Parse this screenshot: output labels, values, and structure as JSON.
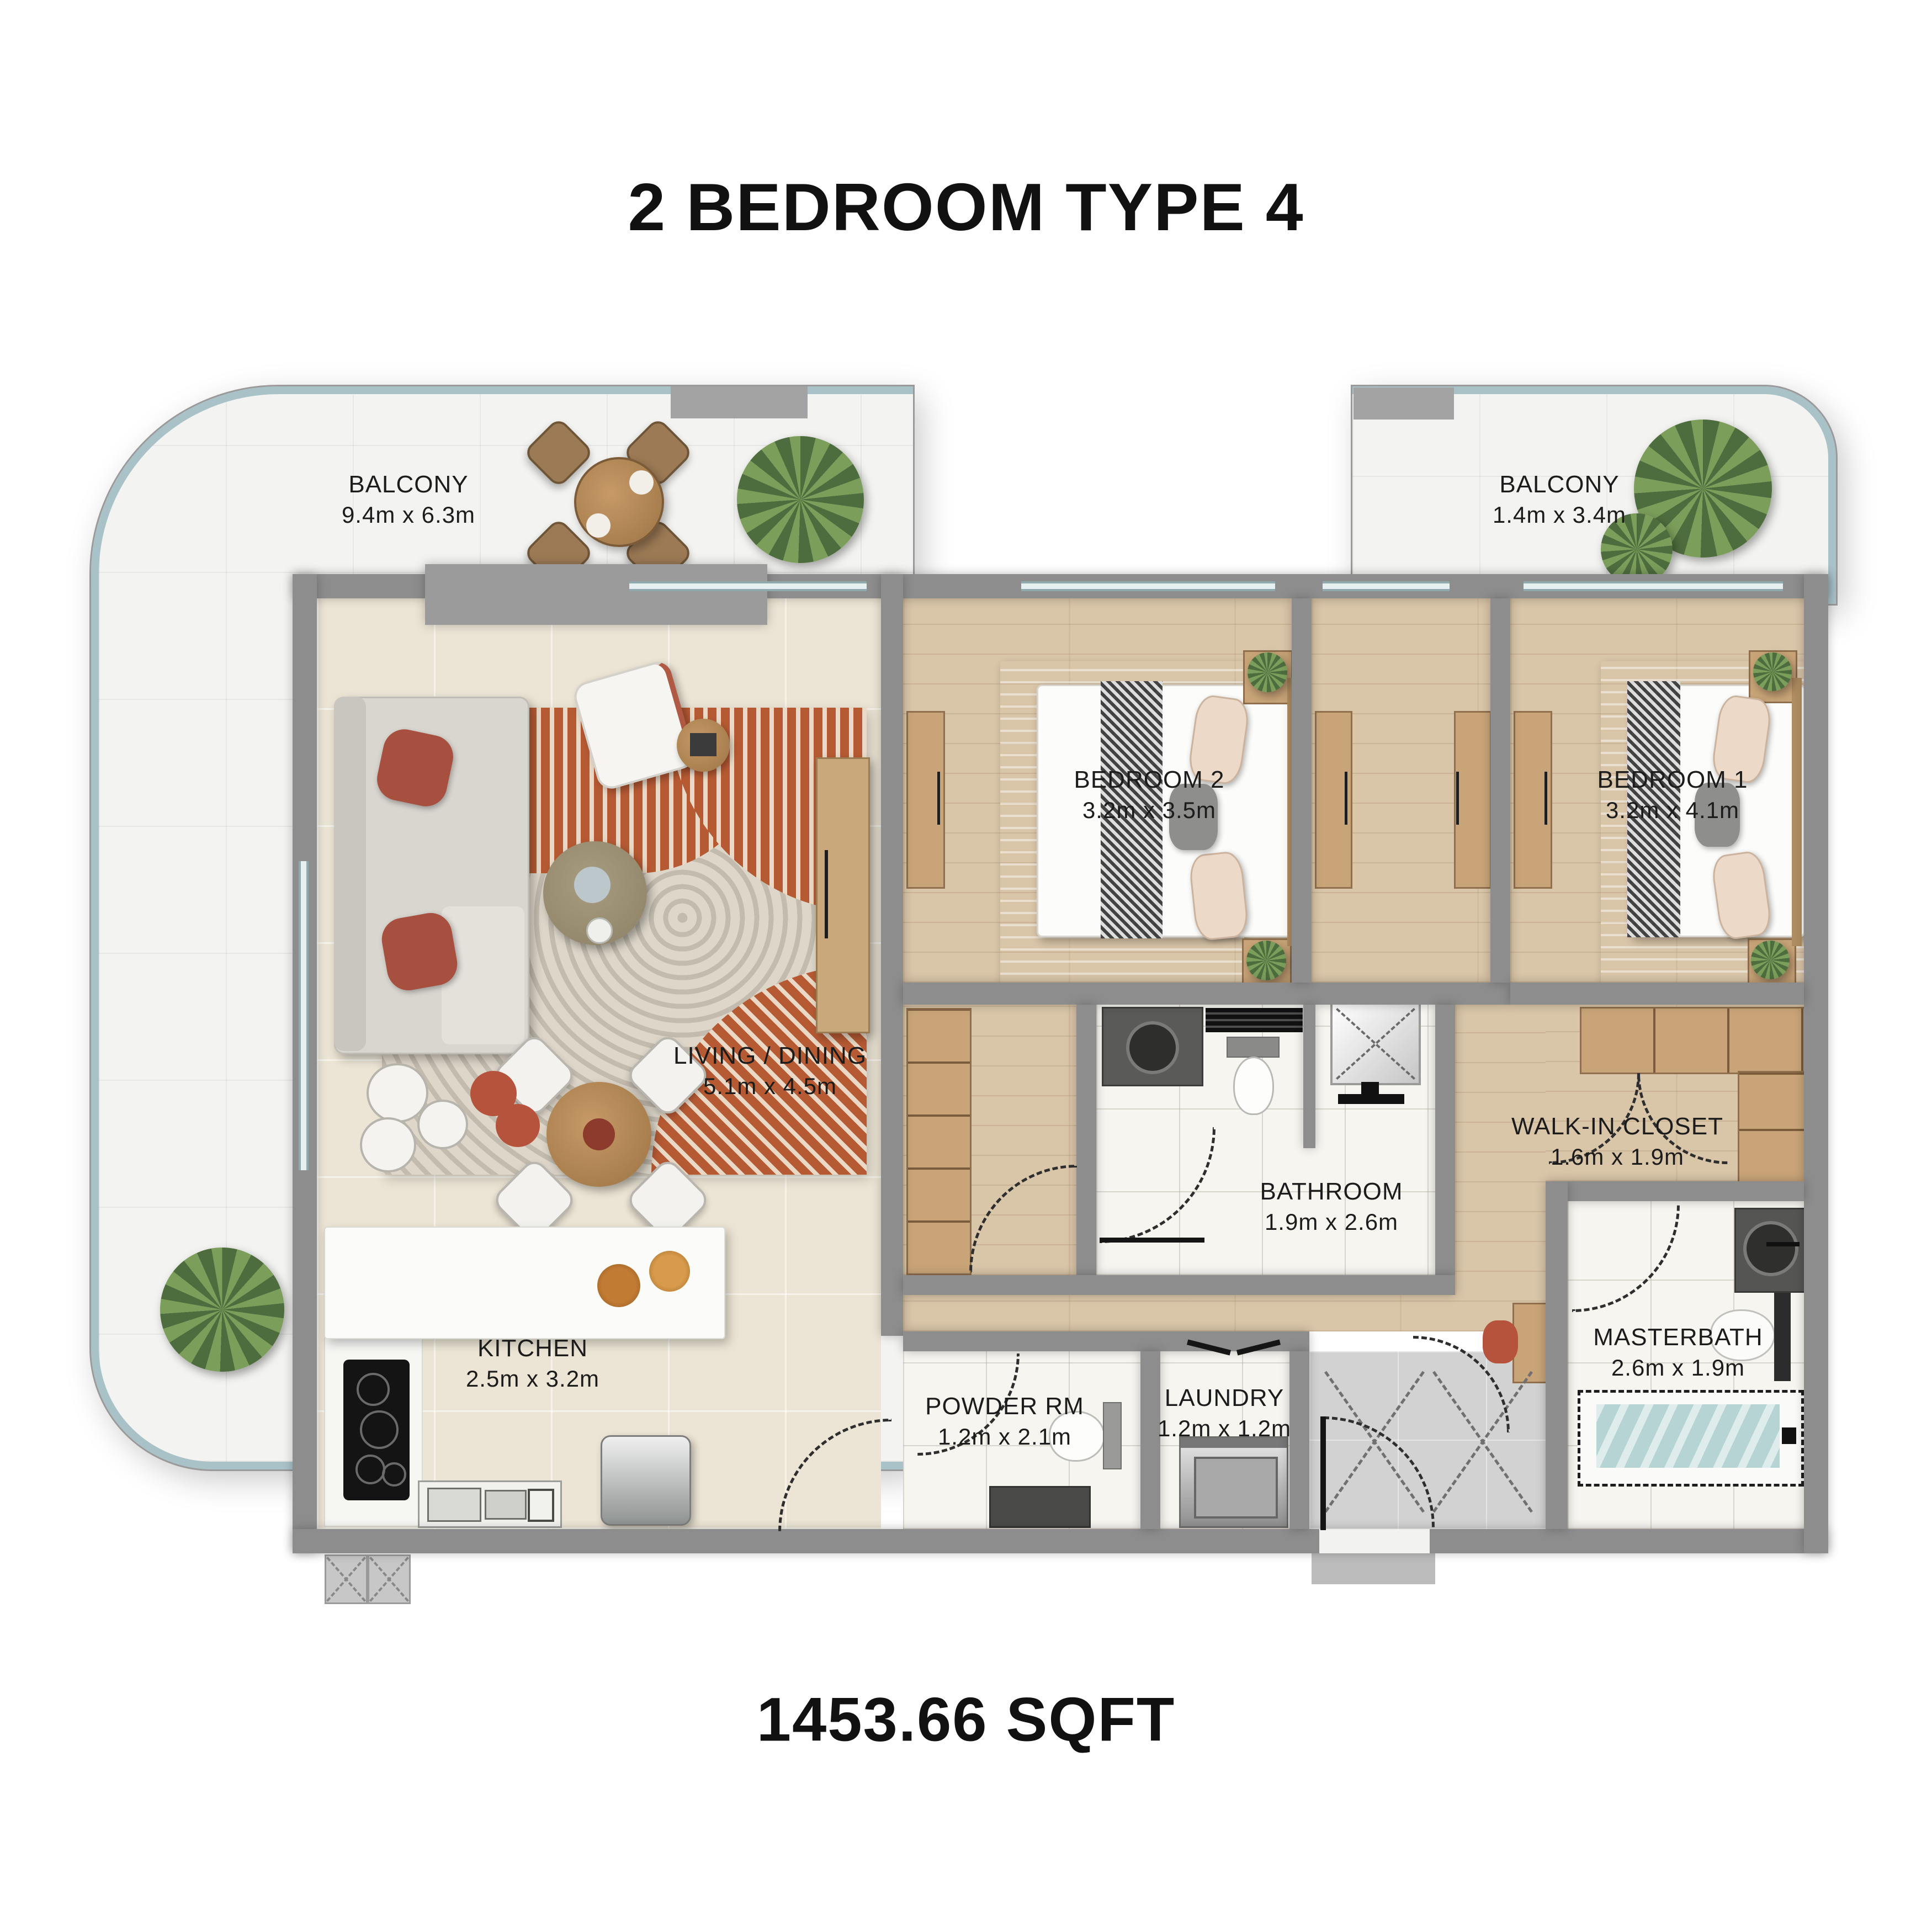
{
  "title": "2 BEDROOM TYPE 4",
  "area": "1453.66 SQFT",
  "rooms": {
    "balcony_left": {
      "name": "BALCONY",
      "dims": "9.4m x 6.3m"
    },
    "balcony_right": {
      "name": "BALCONY",
      "dims": "1.4m x 3.4m"
    },
    "bedroom2": {
      "name": "BEDROOM 2",
      "dims": "3.2m x 3.5m"
    },
    "bedroom1": {
      "name": "BEDROOM 1",
      "dims": "3.2m x 4.1m"
    },
    "living_dining": {
      "name": "LIVING / DINING",
      "dims": "5.1m x 4.5m"
    },
    "bathroom": {
      "name": "BATHROOM",
      "dims": "1.9m x 2.6m"
    },
    "walk_in_closet": {
      "name": "WALK-IN CLOSET",
      "dims": "1.6m x 1.9m"
    },
    "kitchen": {
      "name": "KITCHEN",
      "dims": "2.5m x 3.2m"
    },
    "powder_room": {
      "name": "POWDER RM",
      "dims": "1.2m x 2.1m"
    },
    "laundry": {
      "name": "LAUNDRY",
      "dims": "1.2m x 1.2m"
    },
    "masterbath": {
      "name": "MASTERBATH",
      "dims": "2.6m x 1.9m"
    }
  },
  "colors": {
    "wall": "#8d8d8d",
    "balcony_railing": "#a9c2c8",
    "wood_floor": "#d9c5a8",
    "cream_floor": "#ece5d5",
    "rug_orange": "#b65a33",
    "pillow_red": "#a8503f",
    "bath_water": "#b7d4d4"
  }
}
